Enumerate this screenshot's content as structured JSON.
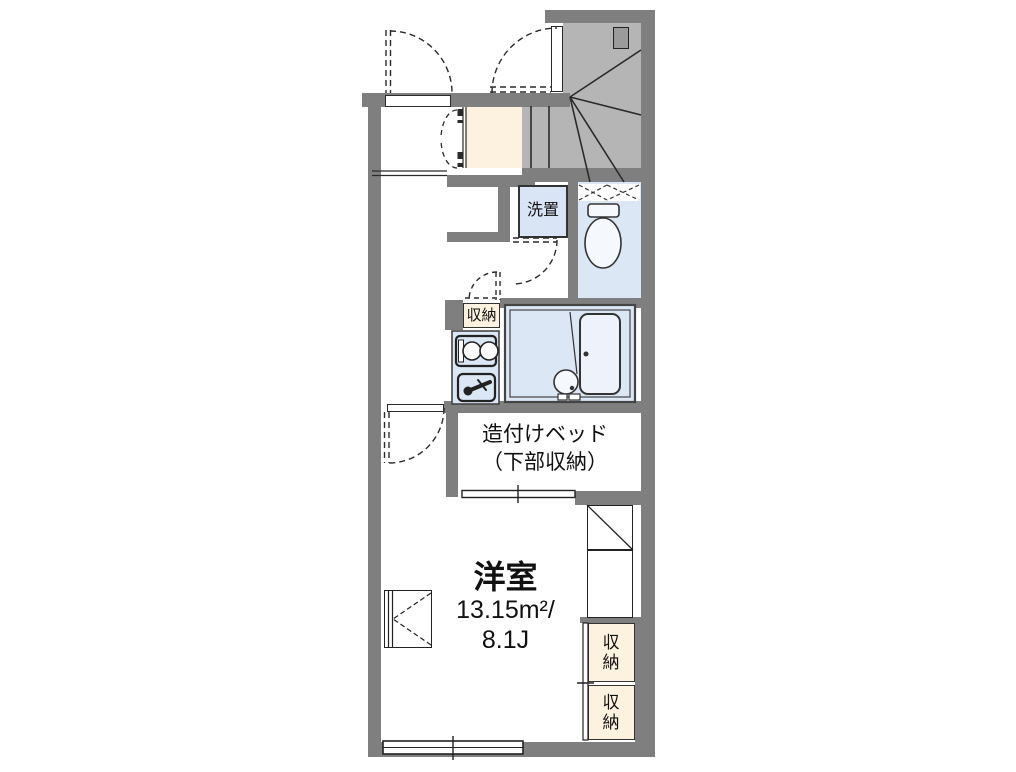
{
  "plan": {
    "rooms": {
      "main_room": {
        "name": "洋室",
        "area_sqm": "13.15m²/",
        "area_tatami": "8.1J"
      },
      "built_in_bed": {
        "line1": "造付けベッド",
        "line2": "（下部収納）"
      },
      "washer_space": {
        "label": "洗置"
      },
      "storage_kitchen": {
        "label": "収納"
      },
      "storage_right_upper": {
        "label": "収納"
      },
      "storage_right_lower": {
        "label": "収納"
      }
    },
    "colors": {
      "wall": "#7f7f7f",
      "stair_fill": "#b5b5b5",
      "stair_landing": "#9b9b9b",
      "floor_cream": "#fcf2df",
      "water_blue": "#dce7f6",
      "washer_blue": "#d9e5f5",
      "line": "#2a2a2a"
    }
  }
}
